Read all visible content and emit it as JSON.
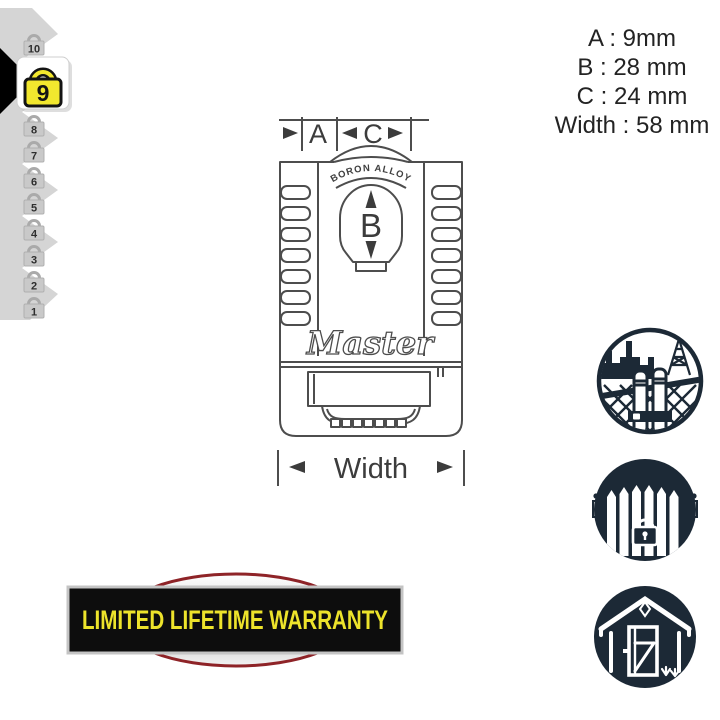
{
  "page": {
    "background": "#ffffff"
  },
  "dimensions_panel": {
    "line_a": "A : 9mm",
    "line_b": "B : 28 mm",
    "line_c": "C : 24 mm",
    "line_width": "Width : 58 mm"
  },
  "diagram": {
    "label_a": "A",
    "label_c": "C",
    "label_b": "B",
    "label_width": "Width",
    "shackle_text": "BORON ALLOY",
    "brand": "Master"
  },
  "security_meter": {
    "selected_level": "9",
    "levels": [
      {
        "label": "10",
        "highlighted": false
      },
      {
        "label": "9",
        "highlighted": true
      },
      {
        "label": "8",
        "highlighted": false
      },
      {
        "label": "7",
        "highlighted": false
      },
      {
        "label": "6",
        "highlighted": false
      },
      {
        "label": "5",
        "highlighted": false
      },
      {
        "label": "4",
        "highlighted": false
      },
      {
        "label": "3",
        "highlighted": false
      },
      {
        "label": "2",
        "highlighted": false
      },
      {
        "label": "1",
        "highlighted": false
      }
    ],
    "colors": {
      "highlight_yellow": "#f2e72e",
      "scale_gray": "#c9c9c9",
      "arrow_black": "#000000"
    }
  },
  "use_icons": [
    {
      "name": "industrial-site-icon"
    },
    {
      "name": "fence-gate-icon"
    },
    {
      "name": "garden-shed-icon"
    }
  ],
  "warranty": {
    "text": "LIMITED LIFETIME WARRANTY",
    "text_color": "#ede32b",
    "bar_color": "#0d0d0d",
    "ellipse_border_color": "#8e2327"
  },
  "colors": {
    "icon_navy": "#1c2936",
    "line_art": "#4d4d4d"
  }
}
